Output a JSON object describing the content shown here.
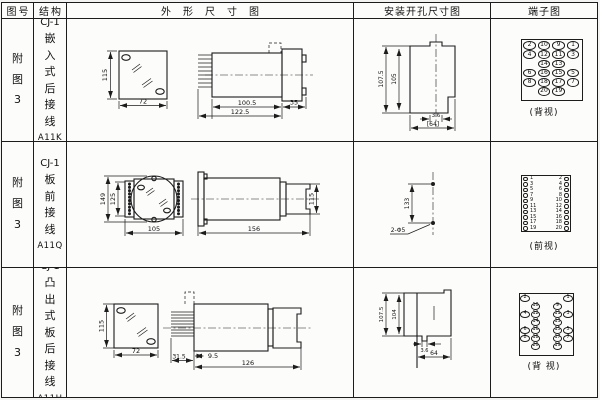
{
  "header": {
    "fig_no": "图号",
    "structure": "结构",
    "outline": "外形尺寸图",
    "mounting": "安装开孔尺寸图",
    "terminal": "端子图"
  },
  "rows": [
    {
      "fig_no": "附图3",
      "structure": {
        "model": "CJ-1",
        "desc": "嵌入式后接线",
        "code": "A11K"
      },
      "outline": {
        "front_h": "115",
        "front_w": "72",
        "len_body": "100.5",
        "len_total": "122.5",
        "flange": "35"
      },
      "mounting": {
        "h_outer": "107.5",
        "h_inner": "105",
        "notch": "3.6",
        "width": "[64]"
      },
      "terminal": {
        "layout": "grid",
        "caption": "(背视)",
        "grid": [
          [
            "2",
            "10",
            "9",
            "1"
          ],
          [
            "4",
            "12",
            "11",
            "3"
          ],
          [
            "",
            "14",
            "13",
            ""
          ],
          [
            "6",
            "16",
            "15",
            "5"
          ],
          [
            "8",
            "18",
            "17",
            "7"
          ],
          [
            "",
            "20",
            "19",
            ""
          ]
        ]
      }
    },
    {
      "fig_no": "附图3",
      "structure": {
        "model": "CJ-1",
        "desc": "板前接线",
        "code": "A11Q"
      },
      "outline": {
        "front_h": "149",
        "front_inner_h": "125",
        "front_w": "105",
        "len_total": "156",
        "side_h": "115"
      },
      "mounting": {
        "hole_span": "133",
        "hole_label": "2-Φ5"
      },
      "terminal": {
        "layout": "columns",
        "caption": "(前视)",
        "left": [
          "1",
          "3",
          "5",
          "7",
          "9",
          "11",
          "13",
          "15",
          "17",
          "19"
        ],
        "right": [
          "2",
          "4",
          "6",
          "8",
          "10",
          "12",
          "14",
          "16",
          "18",
          "20"
        ]
      }
    },
    {
      "fig_no": "附图3",
      "structure": {
        "model": "CJ-1",
        "desc": "凸出式板后接线",
        "code": "A11H"
      },
      "outline": {
        "front_h": "115",
        "front_w": "72",
        "pin_len": "31.5",
        "offset": "9.5",
        "len_body": "126"
      },
      "mounting": {
        "h_outer": "107.5",
        "h_inner": "104",
        "notch": "3.6",
        "width": "64"
      },
      "terminal": {
        "layout": "stagger",
        "caption": "(背 视)",
        "left": [
          [
            "2",
            ""
          ],
          [
            "",
            "10"
          ],
          [
            "4",
            "12"
          ],
          [
            "",
            "14"
          ],
          [
            "6",
            "16"
          ],
          [
            "8",
            "18"
          ],
          [
            "",
            "20"
          ]
        ],
        "right": [
          [
            "1",
            ""
          ],
          [
            "",
            "9"
          ],
          [
            "3",
            "11"
          ],
          [
            "",
            "13"
          ],
          [
            "5",
            "15"
          ],
          [
            "7",
            "17"
          ],
          [
            "",
            "19"
          ]
        ]
      }
    }
  ]
}
